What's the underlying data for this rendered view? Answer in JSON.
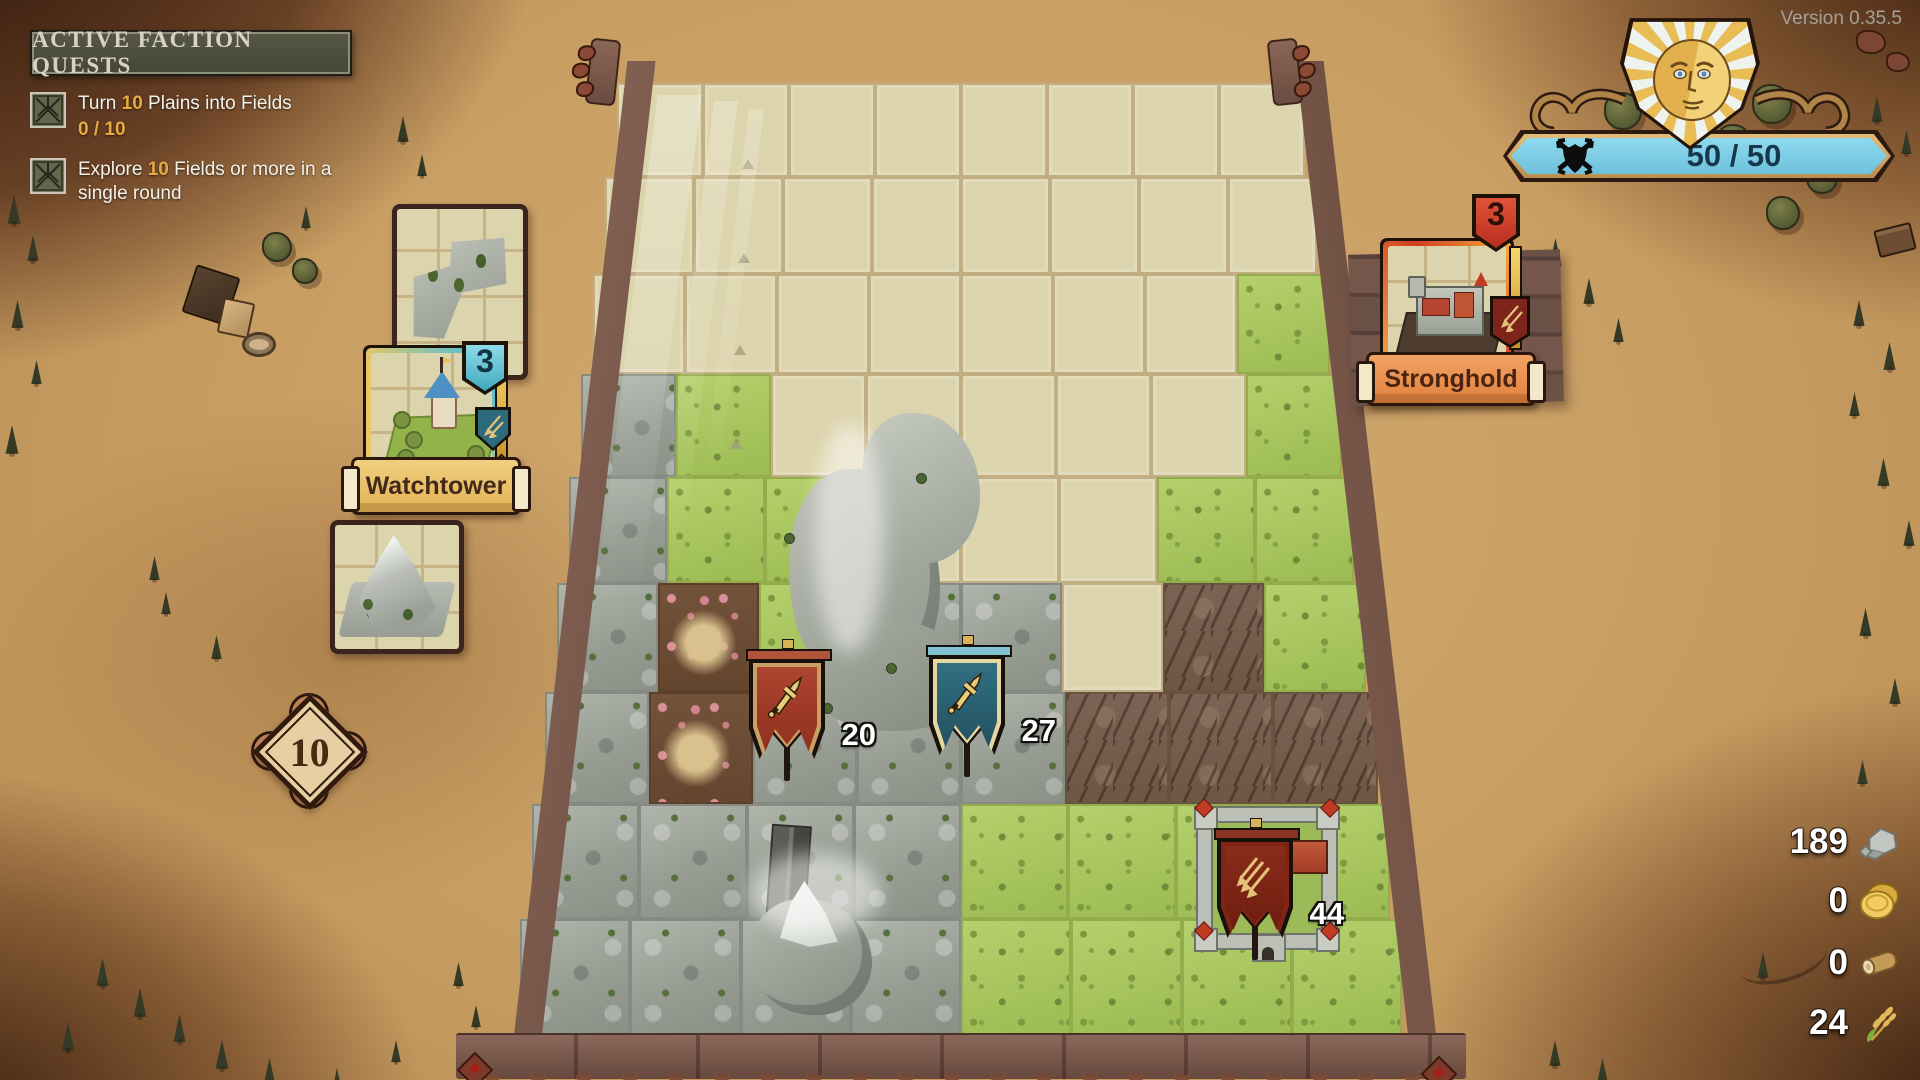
{
  "version_label": "Version 0.35.5",
  "quest_panel": {
    "title": "ACTIVE FACTION QUESTS",
    "quests": [
      {
        "prefix": "Turn ",
        "amount": "10",
        "suffix": " Plains into Fields",
        "progress": "0 / 10"
      },
      {
        "prefix": "Explore ",
        "amount": "10",
        "suffix": " Fields or more in a single round"
      }
    ]
  },
  "faction": {
    "hp": "50 / 50",
    "emblem": "sun-face-shield"
  },
  "hand": {
    "tile_card": "corner-rock-tile",
    "watchtower": {
      "name": "Watchtower",
      "count": "3"
    },
    "mountain_card": "mountain-tile",
    "round_counter": "10",
    "stronghold": {
      "name": "Stronghold",
      "count": "3"
    }
  },
  "armies": [
    {
      "color": "red",
      "icon": "sword",
      "strength": "20"
    },
    {
      "color": "teal",
      "icon": "sword",
      "strength": "27"
    },
    {
      "color": "dark-red",
      "icon": "arrows",
      "strength": "44"
    }
  ],
  "resources": [
    {
      "name": "stone",
      "value": "189"
    },
    {
      "name": "gold",
      "value": "0"
    },
    {
      "name": "wood",
      "value": "0"
    },
    {
      "name": "wheat",
      "value": "24"
    }
  ],
  "board": {
    "columns": 8,
    "rows": 9,
    "legend": {
      "u": "unexplored",
      "g": "grass",
      "r": "rock",
      "c": "canyon",
      "d": "dirt",
      "v": "village-rock",
      "k": "castle-grass"
    },
    "tiles": [
      "uuuuuuuu",
      "uuuuuuuu",
      "uuuuuuug",
      "rguuuuug",
      "rgguuugg",
      "rdgrrucg",
      "rdrrrccc",
      "rrrrggkg",
      "rrrvgggg"
    ]
  },
  "scenery": [
    {
      "t": "pine",
      "x": 6,
      "y": 195,
      "s": 16
    },
    {
      "t": "pine",
      "x": 26,
      "y": 235,
      "s": 14
    },
    {
      "t": "pine",
      "x": 10,
      "y": 300,
      "s": 15
    },
    {
      "t": "pine",
      "x": 30,
      "y": 360,
      "s": 13
    },
    {
      "t": "pine",
      "x": 4,
      "y": 425,
      "s": 16
    },
    {
      "t": "pine",
      "x": 148,
      "y": 556,
      "s": 13
    },
    {
      "t": "pine",
      "x": 160,
      "y": 592,
      "s": 12
    },
    {
      "t": "pine",
      "x": 210,
      "y": 635,
      "s": 13
    },
    {
      "t": "pine",
      "x": 396,
      "y": 116,
      "s": 14
    },
    {
      "t": "pine",
      "x": 416,
      "y": 154,
      "s": 12
    },
    {
      "t": "pine",
      "x": 300,
      "y": 206,
      "s": 12
    },
    {
      "t": "pine",
      "x": 60,
      "y": 1022,
      "s": 16
    },
    {
      "t": "pine",
      "x": 95,
      "y": 958,
      "s": 15
    },
    {
      "t": "pine",
      "x": 132,
      "y": 988,
      "s": 16
    },
    {
      "t": "pine",
      "x": 172,
      "y": 1014,
      "s": 15
    },
    {
      "t": "pine",
      "x": 214,
      "y": 1040,
      "s": 16
    },
    {
      "t": "pine",
      "x": 262,
      "y": 1058,
      "s": 15
    },
    {
      "t": "pine",
      "x": 330,
      "y": 1068,
      "s": 14
    },
    {
      "t": "pine",
      "x": 390,
      "y": 1040,
      "s": 12
    },
    {
      "t": "pine",
      "x": 452,
      "y": 962,
      "s": 13
    },
    {
      "t": "pine",
      "x": 470,
      "y": 1005,
      "s": 12
    },
    {
      "t": "pine",
      "x": 1548,
      "y": 238,
      "s": 15
    },
    {
      "t": "pine",
      "x": 1582,
      "y": 278,
      "s": 14
    },
    {
      "t": "pine",
      "x": 1612,
      "y": 318,
      "s": 13
    },
    {
      "t": "pine",
      "x": 1870,
      "y": 96,
      "s": 14
    },
    {
      "t": "pine",
      "x": 1900,
      "y": 130,
      "s": 13
    },
    {
      "t": "pine",
      "x": 1852,
      "y": 300,
      "s": 14
    },
    {
      "t": "pine",
      "x": 1882,
      "y": 342,
      "s": 15
    },
    {
      "t": "pine",
      "x": 1848,
      "y": 392,
      "s": 13
    },
    {
      "t": "pine",
      "x": 1876,
      "y": 458,
      "s": 15
    },
    {
      "t": "pine",
      "x": 1902,
      "y": 520,
      "s": 14
    },
    {
      "t": "pine",
      "x": 1858,
      "y": 608,
      "s": 15
    },
    {
      "t": "pine",
      "x": 1888,
      "y": 678,
      "s": 14
    },
    {
      "t": "pine",
      "x": 1856,
      "y": 760,
      "s": 13
    },
    {
      "t": "pine",
      "x": 1548,
      "y": 1040,
      "s": 14
    },
    {
      "t": "pine",
      "x": 1596,
      "y": 1058,
      "s": 13
    },
    {
      "t": "pine",
      "x": 1756,
      "y": 952,
      "s": 14
    },
    {
      "t": "tree",
      "x": 1604,
      "y": 92,
      "s": 34
    },
    {
      "t": "tree",
      "x": 1652,
      "y": 70,
      "s": 38
    },
    {
      "t": "tree",
      "x": 1706,
      "y": 52,
      "s": 40
    },
    {
      "t": "tree",
      "x": 1752,
      "y": 84,
      "s": 36
    },
    {
      "t": "tree",
      "x": 1666,
      "y": 132,
      "s": 30
    },
    {
      "t": "tree",
      "x": 1716,
      "y": 124,
      "s": 32
    },
    {
      "t": "tree",
      "x": 1766,
      "y": 196,
      "s": 30
    },
    {
      "t": "tree",
      "x": 1806,
      "y": 162,
      "s": 28
    },
    {
      "t": "tree",
      "x": 262,
      "y": 232,
      "s": 26
    },
    {
      "t": "tree",
      "x": 292,
      "y": 258,
      "s": 22
    }
  ],
  "colors": {
    "hp_blue": "#8ed9ee",
    "hp_text": "#17374c",
    "gold": "#e2b457",
    "card_teal": "#56c2d6",
    "card_gold": "#e9c360",
    "frame_red": "#cf3f21",
    "banner_gold": "#eec56f",
    "banner_orange": "#ef9b5c",
    "flag_red": "#a23b25",
    "flag_teal": "#2b6476",
    "flag_darkred": "#802516",
    "quest_amount": "#e9a93e",
    "sand": "#c89e63"
  }
}
